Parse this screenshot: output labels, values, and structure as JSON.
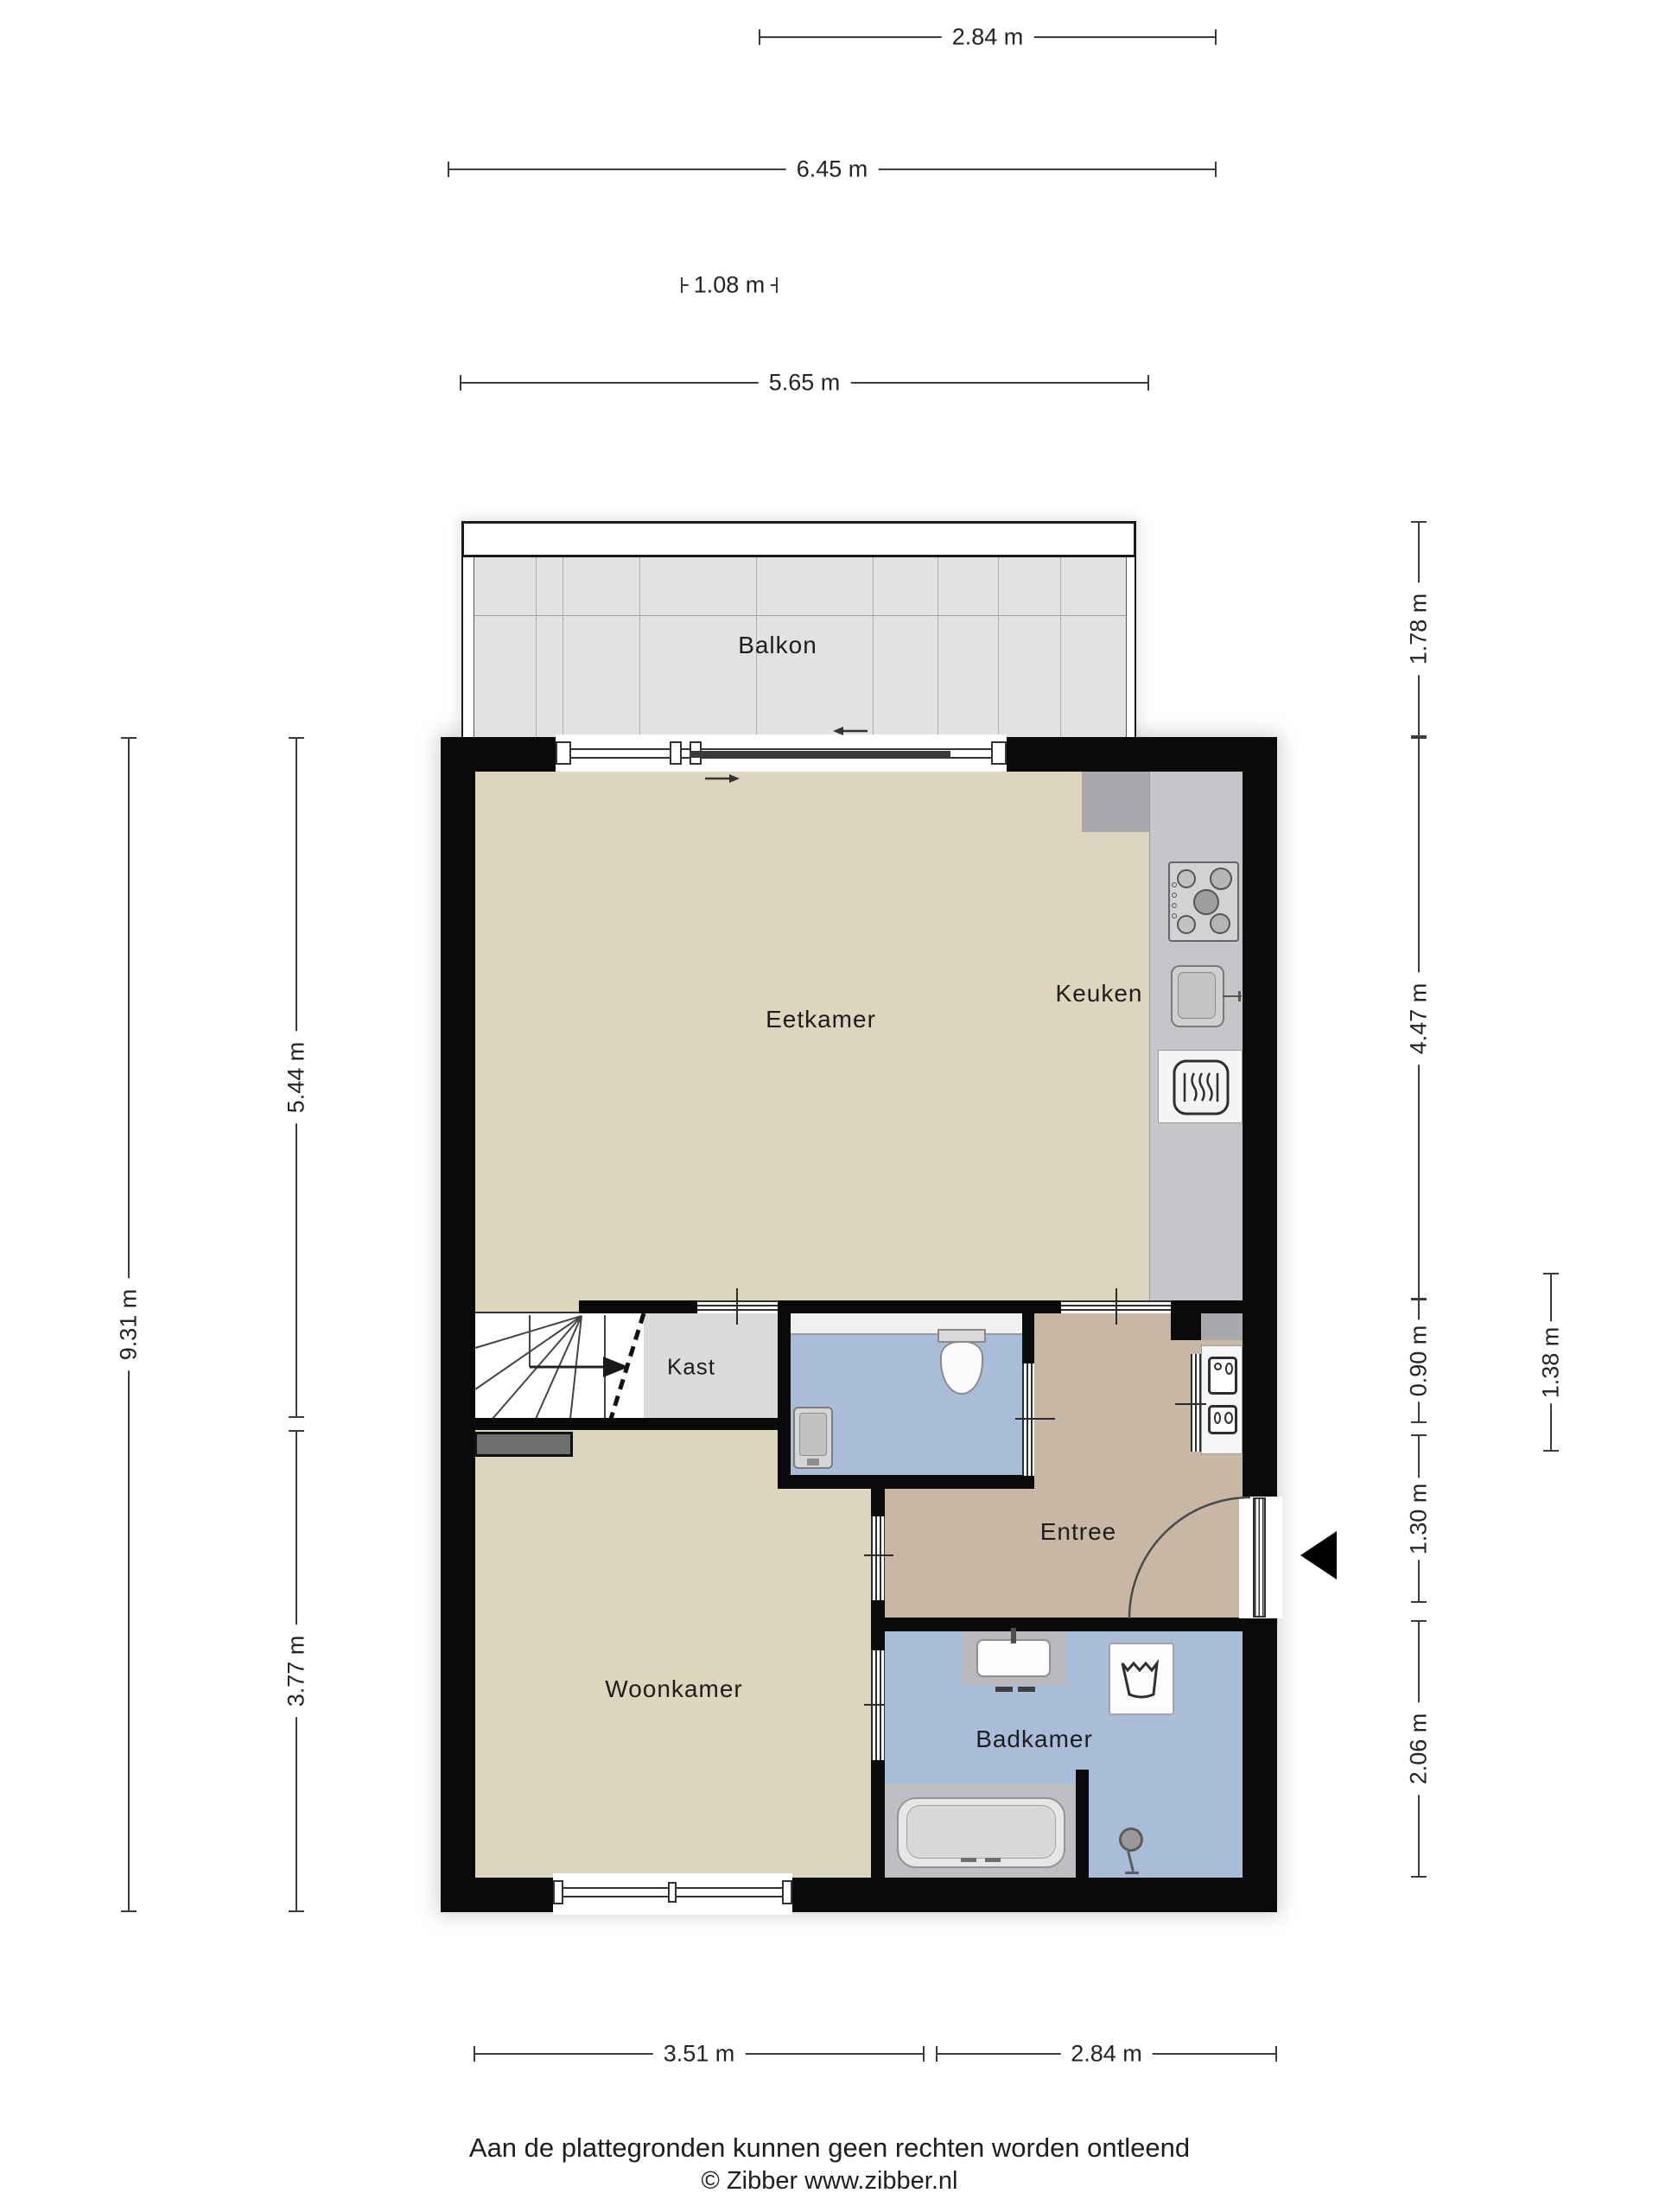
{
  "rooms": {
    "balkon": "Balkon",
    "eetkamer": "Eetkamer",
    "keuken": "Keuken",
    "kast": "Kast",
    "entree": "Entree",
    "woonkamer": "Woonkamer",
    "badkamer": "Badkamer"
  },
  "dimensions": {
    "top_kitchen_width": "2.84 m",
    "top_total_width": "6.45 m",
    "balcony_door_width": "1.08 m",
    "balcony_width": "5.65 m",
    "left_total_height": "9.31 m",
    "left_upper_height": "5.44 m",
    "left_lower_height": "3.77 m",
    "balcony_depth": "1.78 m",
    "kitchen_height": "4.47 m",
    "meter_closet_height": "0.90 m",
    "entry_height": "1.30 m",
    "bathroom_height": "2.06 m",
    "hall_width": "1.38 m",
    "bottom_left_width": "3.51 m",
    "bottom_right_width": "2.84 m"
  },
  "footer": {
    "disclaimer": "Aan de plattegronden kunnen geen rechten worden ontleend",
    "copyright": "© Zibber www.zibber.nl"
  },
  "colors": {
    "wall": "#0a0a0a",
    "floor_living": "#ded6bc",
    "floor_hall": "#c9b7a5",
    "floor_wet": "#aabdd8",
    "floor_closet": "#dbdbd9",
    "floor_balcony": "#e2e2e2",
    "counter": "#c6c6ca",
    "counter_dark": "#a9a9ad",
    "dim_line": "#3c3c3c"
  }
}
